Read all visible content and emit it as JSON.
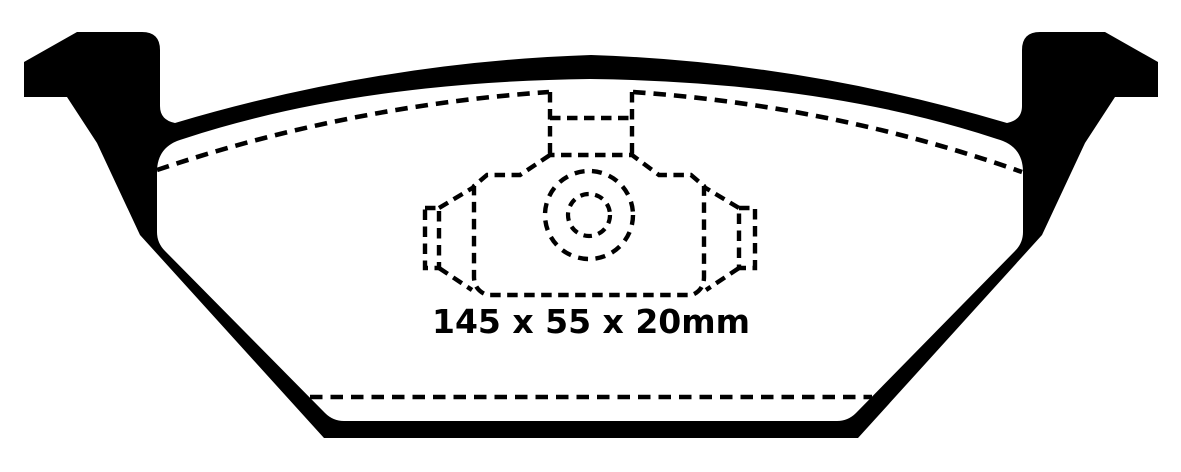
{
  "diagram": {
    "dimension_label": "145 x 55 x 20mm",
    "dimensions_mm": {
      "width": 145,
      "height": 55,
      "thickness": 20
    },
    "colors": {
      "ink": "#000000",
      "background": "#ffffff"
    }
  }
}
